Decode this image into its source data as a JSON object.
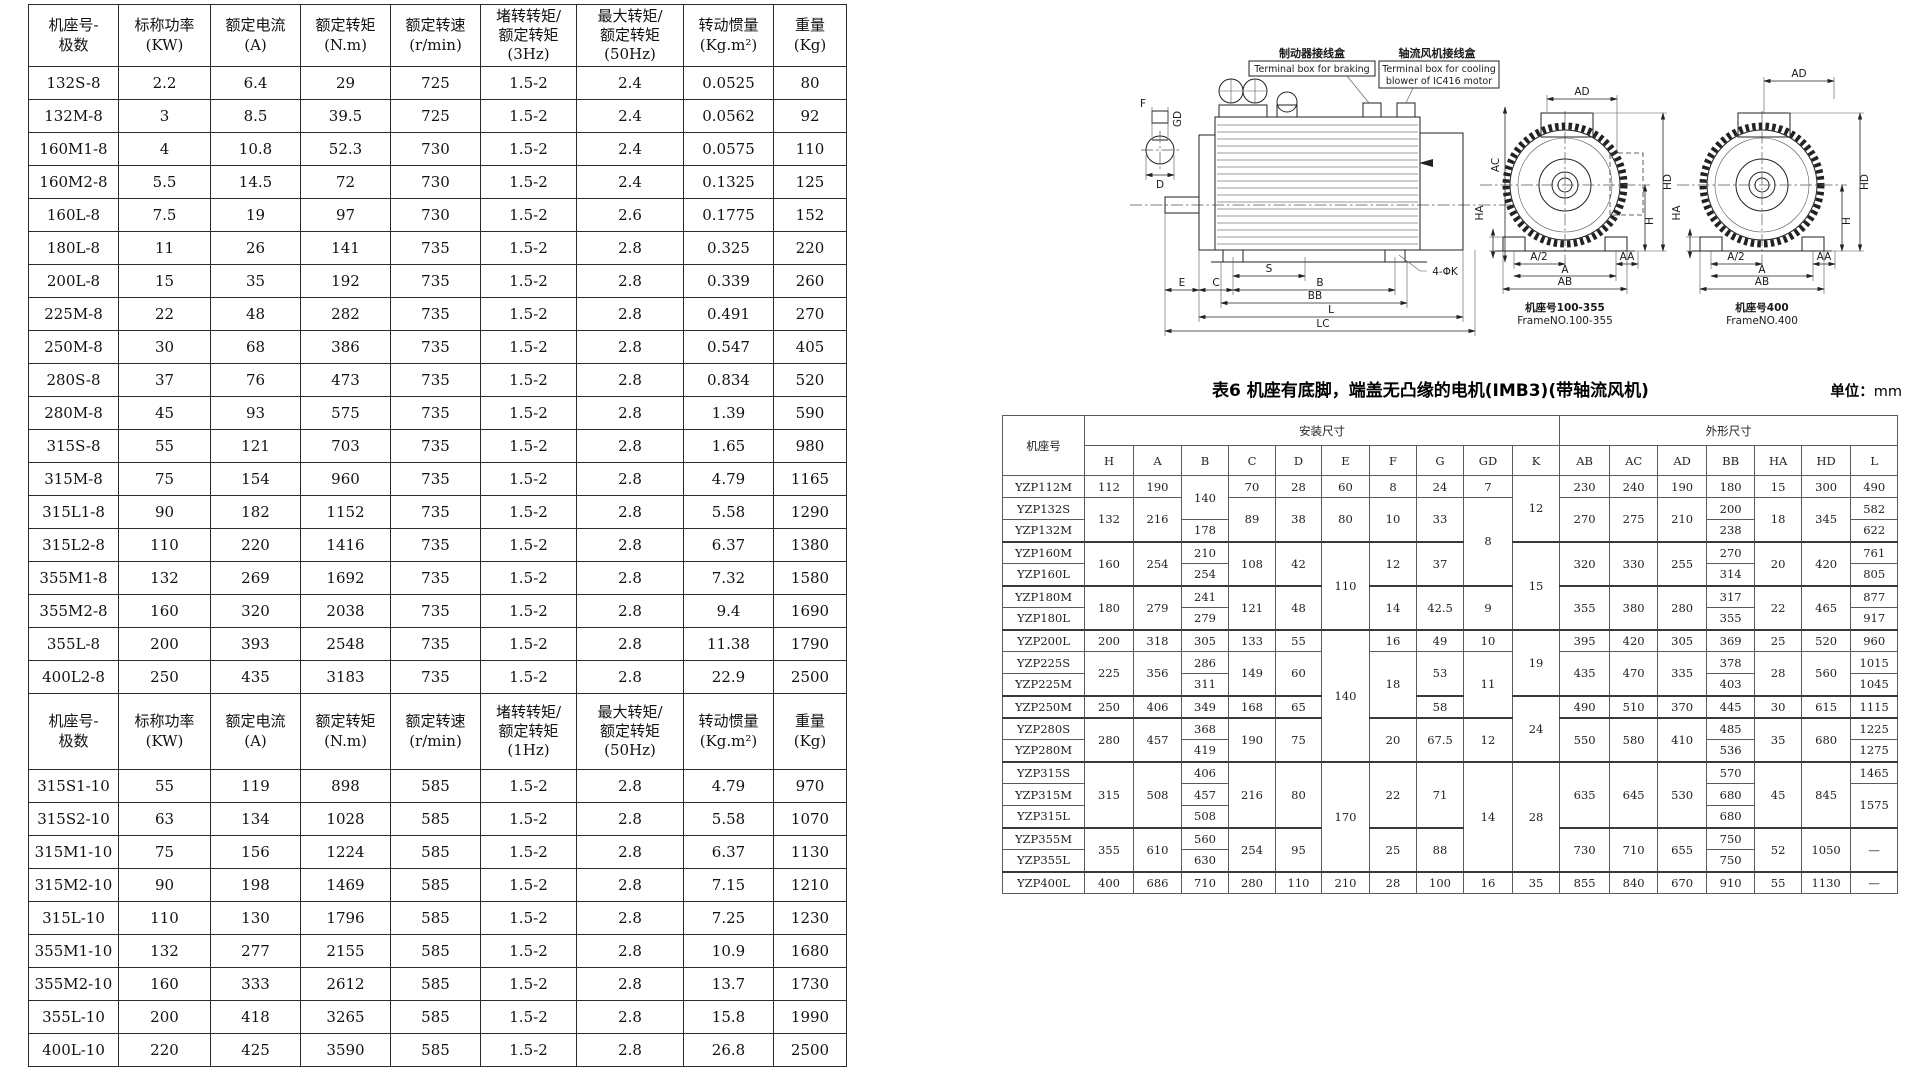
{
  "left_table": {
    "cols": [
      90,
      92,
      90,
      90,
      90,
      96,
      107,
      90,
      73
    ],
    "rows": [
      {
        "cls": "hdr",
        "c": [
          "机座号-\n极数",
          "标称功率\n(KW)",
          "额定电流\n(A)",
          "额定转矩\n(N.m)",
          "额定转速\n(r/min)",
          "堵转转矩/\n额定转矩\n(3Hz)",
          "最大转矩/\n额定转矩\n(50Hz)",
          "转动惯量\n(Kg.m²)",
          "重量\n(Kg)"
        ]
      },
      {
        "c": [
          "132S-8",
          "2.2",
          "6.4",
          "29",
          "725",
          "1.5-2",
          "2.4",
          "0.0525",
          "80"
        ]
      },
      {
        "c": [
          "132M-8",
          "3",
          "8.5",
          "39.5",
          "725",
          "1.5-2",
          "2.4",
          "0.0562",
          "92"
        ]
      },
      {
        "c": [
          "160M1-8",
          "4",
          "10.8",
          "52.3",
          "730",
          "1.5-2",
          "2.4",
          "0.0575",
          "110"
        ]
      },
      {
        "c": [
          "160M2-8",
          "5.5",
          "14.5",
          "72",
          "730",
          "1.5-2",
          "2.4",
          "0.1325",
          "125"
        ]
      },
      {
        "c": [
          "160L-8",
          "7.5",
          "19",
          "97",
          "730",
          "1.5-2",
          "2.6",
          "0.1775",
          "152"
        ]
      },
      {
        "c": [
          "180L-8",
          "11",
          "26",
          "141",
          "735",
          "1.5-2",
          "2.8",
          "0.325",
          "220"
        ]
      },
      {
        "c": [
          "200L-8",
          "15",
          "35",
          "192",
          "735",
          "1.5-2",
          "2.8",
          "0.339",
          "260"
        ]
      },
      {
        "c": [
          "225M-8",
          "22",
          "48",
          "282",
          "735",
          "1.5-2",
          "2.8",
          "0.491",
          "270"
        ]
      },
      {
        "c": [
          "250M-8",
          "30",
          "68",
          "386",
          "735",
          "1.5-2",
          "2.8",
          "0.547",
          "405"
        ]
      },
      {
        "c": [
          "280S-8",
          "37",
          "76",
          "473",
          "735",
          "1.5-2",
          "2.8",
          "0.834",
          "520"
        ]
      },
      {
        "c": [
          "280M-8",
          "45",
          "93",
          "575",
          "735",
          "1.5-2",
          "2.8",
          "1.39",
          "590"
        ]
      },
      {
        "c": [
          "315S-8",
          "55",
          "121",
          "703",
          "735",
          "1.5-2",
          "2.8",
          "1.65",
          "980"
        ]
      },
      {
        "c": [
          "315M-8",
          "75",
          "154",
          "960",
          "735",
          "1.5-2",
          "2.8",
          "4.79",
          "1165"
        ]
      },
      {
        "c": [
          "315L1-8",
          "90",
          "182",
          "1152",
          "735",
          "1.5-2",
          "2.8",
          "5.58",
          "1290"
        ]
      },
      {
        "c": [
          "315L2-8",
          "110",
          "220",
          "1416",
          "735",
          "1.5-2",
          "2.8",
          "6.37",
          "1380"
        ]
      },
      {
        "c": [
          "355M1-8",
          "132",
          "269",
          "1692",
          "735",
          "1.5-2",
          "2.8",
          "7.32",
          "1580"
        ]
      },
      {
        "c": [
          "355M2-8",
          "160",
          "320",
          "2038",
          "735",
          "1.5-2",
          "2.8",
          "9.4",
          "1690"
        ]
      },
      {
        "c": [
          "355L-8",
          "200",
          "393",
          "2548",
          "735",
          "1.5-2",
          "2.8",
          "11.38",
          "1790"
        ]
      },
      {
        "c": [
          "400L2-8",
          "250",
          "435",
          "3183",
          "735",
          "1.5-2",
          "2.8",
          "22.9",
          "2500"
        ]
      },
      {
        "cls": "hdr hdr2",
        "c": [
          "机座号-\n极数",
          "标称功率\n(KW)",
          "额定电流\n(A)",
          "额定转矩\n(N.m)",
          "额定转速\n(r/min)",
          "堵转转矩/\n额定转矩\n(1Hz)",
          "最大转矩/\n额定转矩\n(50Hz)",
          "转动惯量\n(Kg.m²)",
          "重量\n(Kg)"
        ]
      },
      {
        "c": [
          "315S1-10",
          "55",
          "119",
          "898",
          "585",
          "1.5-2",
          "2.8",
          "4.79",
          "970"
        ]
      },
      {
        "c": [
          "315S2-10",
          "63",
          "134",
          "1028",
          "585",
          "1.5-2",
          "2.8",
          "5.58",
          "1070"
        ]
      },
      {
        "c": [
          "315M1-10",
          "75",
          "156",
          "1224",
          "585",
          "1.5-2",
          "2.8",
          "6.37",
          "1130"
        ]
      },
      {
        "c": [
          "315M2-10",
          "90",
          "198",
          "1469",
          "585",
          "1.5-2",
          "2.8",
          "7.15",
          "1210"
        ]
      },
      {
        "c": [
          "315L-10",
          "110",
          "130",
          "1796",
          "585",
          "1.5-2",
          "2.8",
          "7.25",
          "1230"
        ]
      },
      {
        "c": [
          "355M1-10",
          "132",
          "277",
          "2155",
          "585",
          "1.5-2",
          "2.8",
          "10.9",
          "1680"
        ]
      },
      {
        "c": [
          "355M2-10",
          "160",
          "333",
          "2612",
          "585",
          "1.5-2",
          "2.8",
          "13.7",
          "1730"
        ]
      },
      {
        "c": [
          "355L-10",
          "200",
          "418",
          "3265",
          "585",
          "1.5-2",
          "2.8",
          "15.8",
          "1990"
        ]
      },
      {
        "c": [
          "400L-10",
          "220",
          "425",
          "3590",
          "585",
          "1.5-2",
          "2.8",
          "26.8",
          "2500"
        ]
      }
    ]
  },
  "table6": {
    "title": "表6 机座有底脚，端盖无凸缘的电机(IMB3)(带轴流风机)",
    "unit_label": "单位：",
    "unit_value": "mm",
    "cols": [
      82,
      49,
      48,
      47,
      47,
      46,
      48,
      47,
      47,
      49,
      47,
      50,
      48,
      49,
      48,
      47,
      49,
      47
    ],
    "rows": [
      {
        "cls": "hdr",
        "c": [
          {
            "t": "机座号",
            "rs": 2
          },
          {
            "t": "安装尺寸",
            "cs": 10
          },
          {
            "t": "外形尺寸",
            "cs": 7
          }
        ]
      },
      {
        "cls": "hdr",
        "c": [
          "H",
          "A",
          "B",
          "C",
          "D",
          "E",
          "F",
          "G",
          "GD",
          "K",
          "AB",
          "AC",
          "AD",
          "BB",
          "HA",
          "HD",
          "L"
        ]
      },
      {
        "c": [
          "YZP112M",
          "112",
          "190",
          {
            "t": "140",
            "rs": 2
          },
          "70",
          "28",
          "60",
          "8",
          "24",
          "7",
          {
            "t": "12",
            "rs": 3
          },
          "230",
          "240",
          "190",
          "180",
          "15",
          "300",
          "490"
        ]
      },
      {
        "c": [
          "YZP132S",
          {
            "t": "132",
            "rs": 2
          },
          {
            "t": "216",
            "rs": 2
          },
          {
            "t": "89",
            "rs": 2
          },
          {
            "t": "38",
            "rs": 2
          },
          {
            "t": "80",
            "rs": 2
          },
          {
            "t": "10",
            "rs": 2
          },
          {
            "t": "33",
            "rs": 2
          },
          {
            "t": "8",
            "rs": 4
          },
          {
            "t": "270",
            "rs": 2
          },
          {
            "t": "275",
            "rs": 2
          },
          {
            "t": "210",
            "rs": 2
          },
          "200",
          {
            "t": "18",
            "rs": 2
          },
          {
            "t": "345",
            "rs": 2
          },
          "582"
        ]
      },
      {
        "c": [
          "YZP132M",
          "178",
          "238",
          "622"
        ]
      },
      {
        "cls": "grp",
        "c": [
          "YZP160M",
          {
            "t": "160",
            "rs": 2
          },
          {
            "t": "254",
            "rs": 2
          },
          "210",
          {
            "t": "108",
            "rs": 2
          },
          {
            "t": "42",
            "rs": 2
          },
          {
            "t": "110",
            "rs": 4
          },
          {
            "t": "12",
            "rs": 2
          },
          {
            "t": "37",
            "rs": 2
          },
          {
            "t": "15",
            "rs": 4
          },
          {
            "t": "320",
            "rs": 2
          },
          {
            "t": "330",
            "rs": 2
          },
          {
            "t": "255",
            "rs": 2
          },
          "270",
          {
            "t": "20",
            "rs": 2
          },
          {
            "t": "420",
            "rs": 2
          },
          "761"
        ]
      },
      {
        "c": [
          "YZP160L",
          "254",
          "314",
          "805"
        ]
      },
      {
        "cls": "grp",
        "c": [
          "YZP180M",
          {
            "t": "180",
            "rs": 2
          },
          {
            "t": "279",
            "rs": 2
          },
          "241",
          {
            "t": "121",
            "rs": 2
          },
          {
            "t": "48",
            "rs": 2
          },
          {
            "t": "14",
            "rs": 2
          },
          {
            "t": "42.5",
            "rs": 2
          },
          {
            "t": "9",
            "rs": 2
          },
          {
            "t": "355",
            "rs": 2
          },
          {
            "t": "380",
            "rs": 2
          },
          {
            "t": "280",
            "rs": 2
          },
          "317",
          {
            "t": "22",
            "rs": 2
          },
          {
            "t": "465",
            "rs": 2
          },
          "877"
        ]
      },
      {
        "c": [
          "YZP180L",
          "279",
          "355",
          "917"
        ]
      },
      {
        "cls": "grp",
        "c": [
          "YZP200L",
          "200",
          "318",
          "305",
          "133",
          "55",
          {
            "t": "140",
            "rs": 6
          },
          "16",
          "49",
          "10",
          {
            "t": "19",
            "rs": 3
          },
          "395",
          "420",
          "305",
          "369",
          "25",
          "520",
          "960"
        ]
      },
      {
        "c": [
          "YZP225S",
          {
            "t": "225",
            "rs": 2
          },
          {
            "t": "356",
            "rs": 2
          },
          "286",
          {
            "t": "149",
            "rs": 2
          },
          {
            "t": "60",
            "rs": 2
          },
          {
            "t": "18",
            "rs": 3
          },
          {
            "t": "53",
            "rs": 2
          },
          {
            "t": "11",
            "rs": 3
          },
          {
            "t": "435",
            "rs": 2
          },
          {
            "t": "470",
            "rs": 2
          },
          {
            "t": "335",
            "rs": 2
          },
          "378",
          {
            "t": "28",
            "rs": 2
          },
          {
            "t": "560",
            "rs": 2
          },
          "1015"
        ]
      },
      {
        "c": [
          "YZP225M",
          "311",
          "403",
          "1045"
        ]
      },
      {
        "cls": "grp",
        "c": [
          "YZP250M",
          "250",
          "406",
          "349",
          "168",
          "65",
          "58",
          {
            "t": "24",
            "rs": 3
          },
          "490",
          "510",
          "370",
          "445",
          "30",
          "615",
          "1115"
        ]
      },
      {
        "cls": "grp",
        "c": [
          "YZP280S",
          {
            "t": "280",
            "rs": 2
          },
          {
            "t": "457",
            "rs": 2
          },
          "368",
          {
            "t": "190",
            "rs": 2
          },
          {
            "t": "75",
            "rs": 2
          },
          {
            "t": "20",
            "rs": 2
          },
          {
            "t": "67.5",
            "rs": 2
          },
          {
            "t": "12",
            "rs": 2
          },
          {
            "t": "550",
            "rs": 2
          },
          {
            "t": "580",
            "rs": 2
          },
          {
            "t": "410",
            "rs": 2
          },
          "485",
          {
            "t": "35",
            "rs": 2
          },
          {
            "t": "680",
            "rs": 2
          },
          "1225"
        ]
      },
      {
        "c": [
          "YZP280M",
          "419",
          "536",
          "1275"
        ]
      },
      {
        "cls": "grp",
        "c": [
          "YZP315S",
          {
            "t": "315",
            "rs": 3
          },
          {
            "t": "508",
            "rs": 3
          },
          "406",
          {
            "t": "216",
            "rs": 3
          },
          {
            "t": "80",
            "rs": 3
          },
          {
            "t": "170",
            "rs": 5
          },
          {
            "t": "22",
            "rs": 3
          },
          {
            "t": "71",
            "rs": 3
          },
          {
            "t": "14",
            "rs": 5
          },
          {
            "t": "28",
            "rs": 5
          },
          {
            "t": "635",
            "rs": 3
          },
          {
            "t": "645",
            "rs": 3
          },
          {
            "t": "530",
            "rs": 3
          },
          "570",
          {
            "t": "45",
            "rs": 3
          },
          {
            "t": "845",
            "rs": 3
          },
          "1465"
        ]
      },
      {
        "c": [
          "YZP315M",
          "457",
          "680",
          {
            "t": "1575",
            "rs": 2
          }
        ]
      },
      {
        "c": [
          "YZP315L",
          "508",
          "680"
        ]
      },
      {
        "cls": "grp",
        "c": [
          "YZP355M",
          {
            "t": "355",
            "rs": 2
          },
          {
            "t": "610",
            "rs": 2
          },
          "560",
          {
            "t": "254",
            "rs": 2
          },
          {
            "t": "95",
            "rs": 2
          },
          {
            "t": "25",
            "rs": 2
          },
          {
            "t": "88",
            "rs": 2
          },
          {
            "t": "730",
            "rs": 2
          },
          {
            "t": "710",
            "rs": 2
          },
          {
            "t": "655",
            "rs": 2
          },
          "750",
          {
            "t": "52",
            "rs": 2
          },
          {
            "t": "1050",
            "rs": 2
          },
          {
            "t": "—",
            "rs": 2
          }
        ]
      },
      {
        "c": [
          "YZP355L",
          "630",
          "750"
        ]
      },
      {
        "cls": "grp",
        "c": [
          "YZP400L",
          "400",
          "686",
          "710",
          "280",
          "110",
          "210",
          "28",
          "100",
          "16",
          "35",
          "855",
          "840",
          "670",
          "910",
          "55",
          "1130",
          "—"
        ]
      }
    ]
  },
  "drawing": {
    "label_brake_cn": "制动器接线盒",
    "label_brake_en": "Terminal box for braking",
    "label_fan_cn": "轴流风机接线盒",
    "label_fan_en1": "Terminal box for cooling",
    "label_fan_en2": "blower of IC416 motor",
    "dim_f": "F",
    "dim_gd": "GD",
    "dim_d": "D",
    "dim_e": "E",
    "dim_c": "C",
    "dim_s": "S",
    "dim_b": "B",
    "dim_bb": "BB",
    "dim_l": "L",
    "dim_lc": "LC",
    "dim_k": "4-ΦK",
    "dim_ac": "AC",
    "dim_ad": "AD",
    "dim_hd": "HD",
    "dim_h": "H",
    "dim_ha": "HA",
    "dim_a2": "A/2",
    "dim_a": "A",
    "dim_ab": "AB",
    "dim_aa": "AA",
    "caption_mid_cn": "机座号100-355",
    "caption_mid_en": "FrameNO.100-355",
    "caption_right_cn": "机座号400",
    "caption_right_en": "FrameNO.400"
  }
}
